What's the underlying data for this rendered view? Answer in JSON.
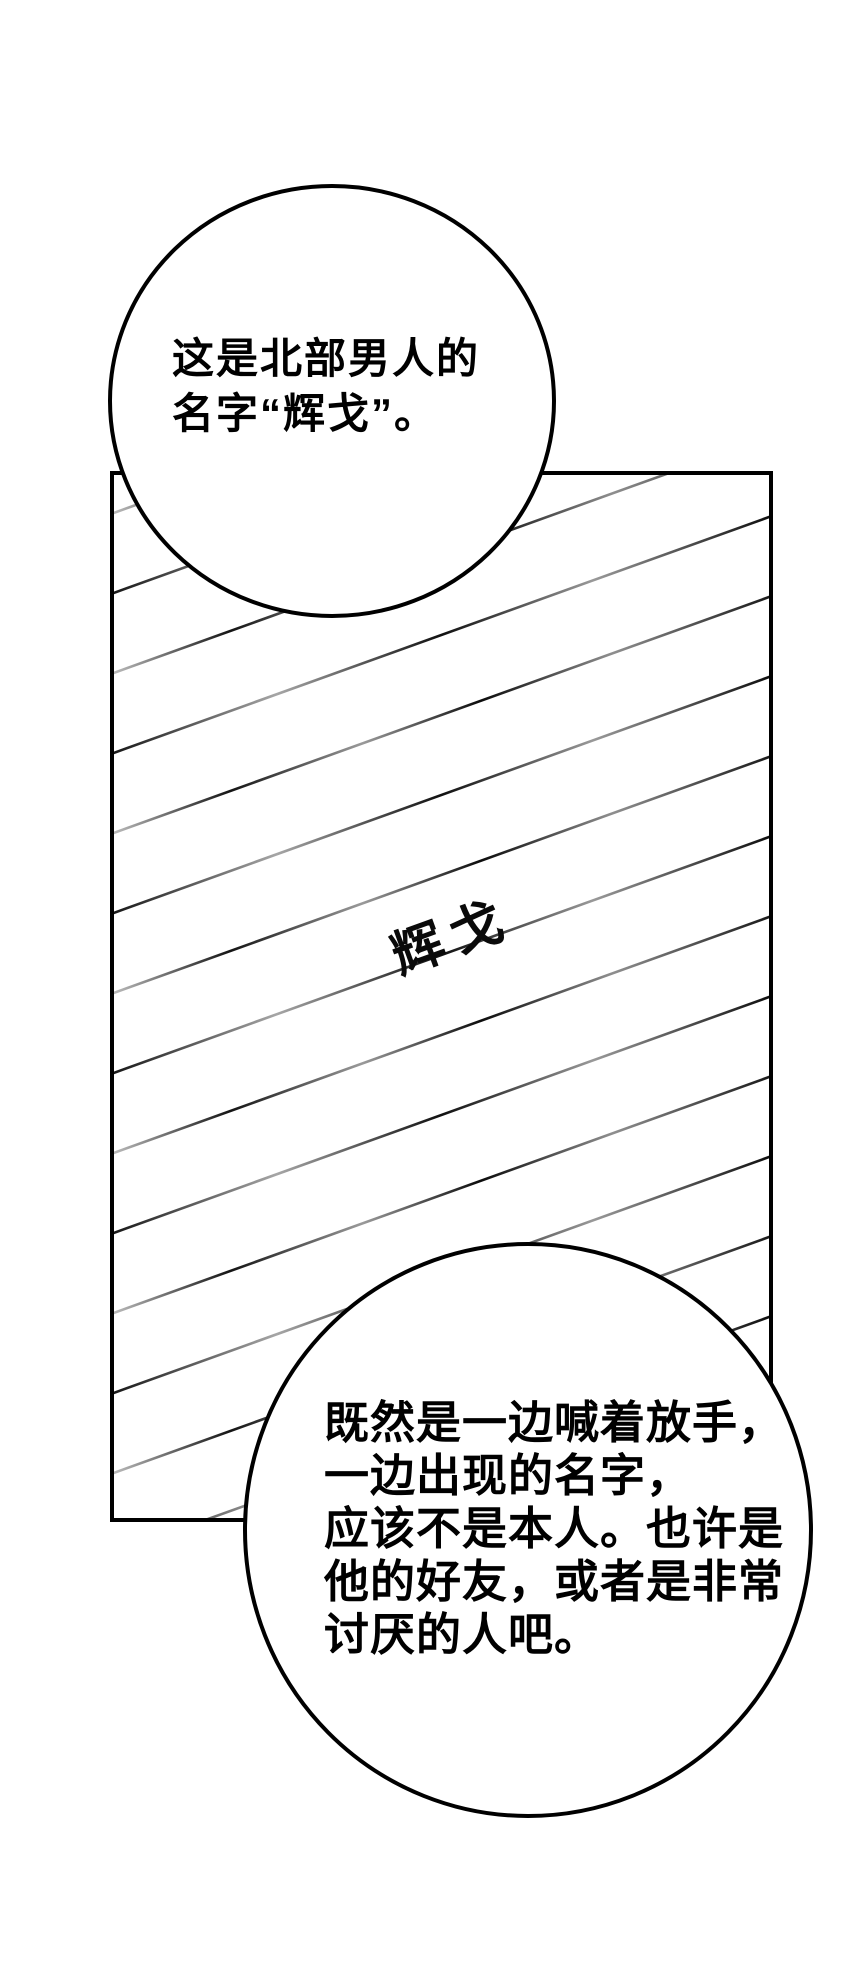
{
  "canvas": {
    "background_color": "#ffffff",
    "ink_color": "#000000"
  },
  "top_bubble": {
    "lines": [
      "这是北部男人的",
      "名字“辉戈”。"
    ]
  },
  "panel": {
    "handwriting": "辉戈"
  },
  "bottom_bubble": {
    "lines": [
      "既然是一边喊着放手，",
      "一边出现的名字，",
      "应该不是本人。也许是",
      "他的好友，或者是非常",
      "讨厌的人吧。"
    ]
  }
}
